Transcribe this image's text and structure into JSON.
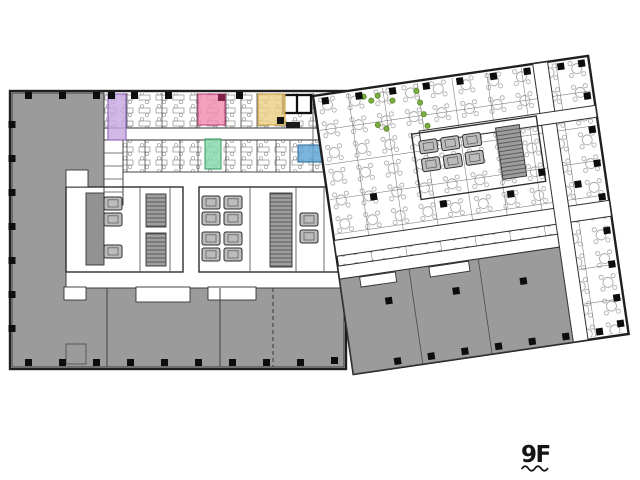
{
  "canvas": {
    "width": 640,
    "height": 480,
    "background": "#ffffff"
  },
  "floor_label": {
    "text": "9F"
  },
  "colors": {
    "wall": "#1f1f1f",
    "open_gray": "#9b9b9b",
    "core_gray": "#a8a8a8",
    "shaft_gray": "#929292",
    "column": "#0d0d0d",
    "plant_green": "#79ad3f",
    "label_black": "#141414"
  },
  "highlight_rooms": {
    "purple": {
      "color": "#c7a8e0"
    },
    "pink": {
      "color": "#f28cb0",
      "corner_column": "#7e1f47"
    },
    "yellow": {
      "color": "#edcf86",
      "corner_column": "#111111"
    },
    "green": {
      "color": "#86d9ab"
    },
    "blue": {
      "color": "#5ea3d6"
    }
  }
}
